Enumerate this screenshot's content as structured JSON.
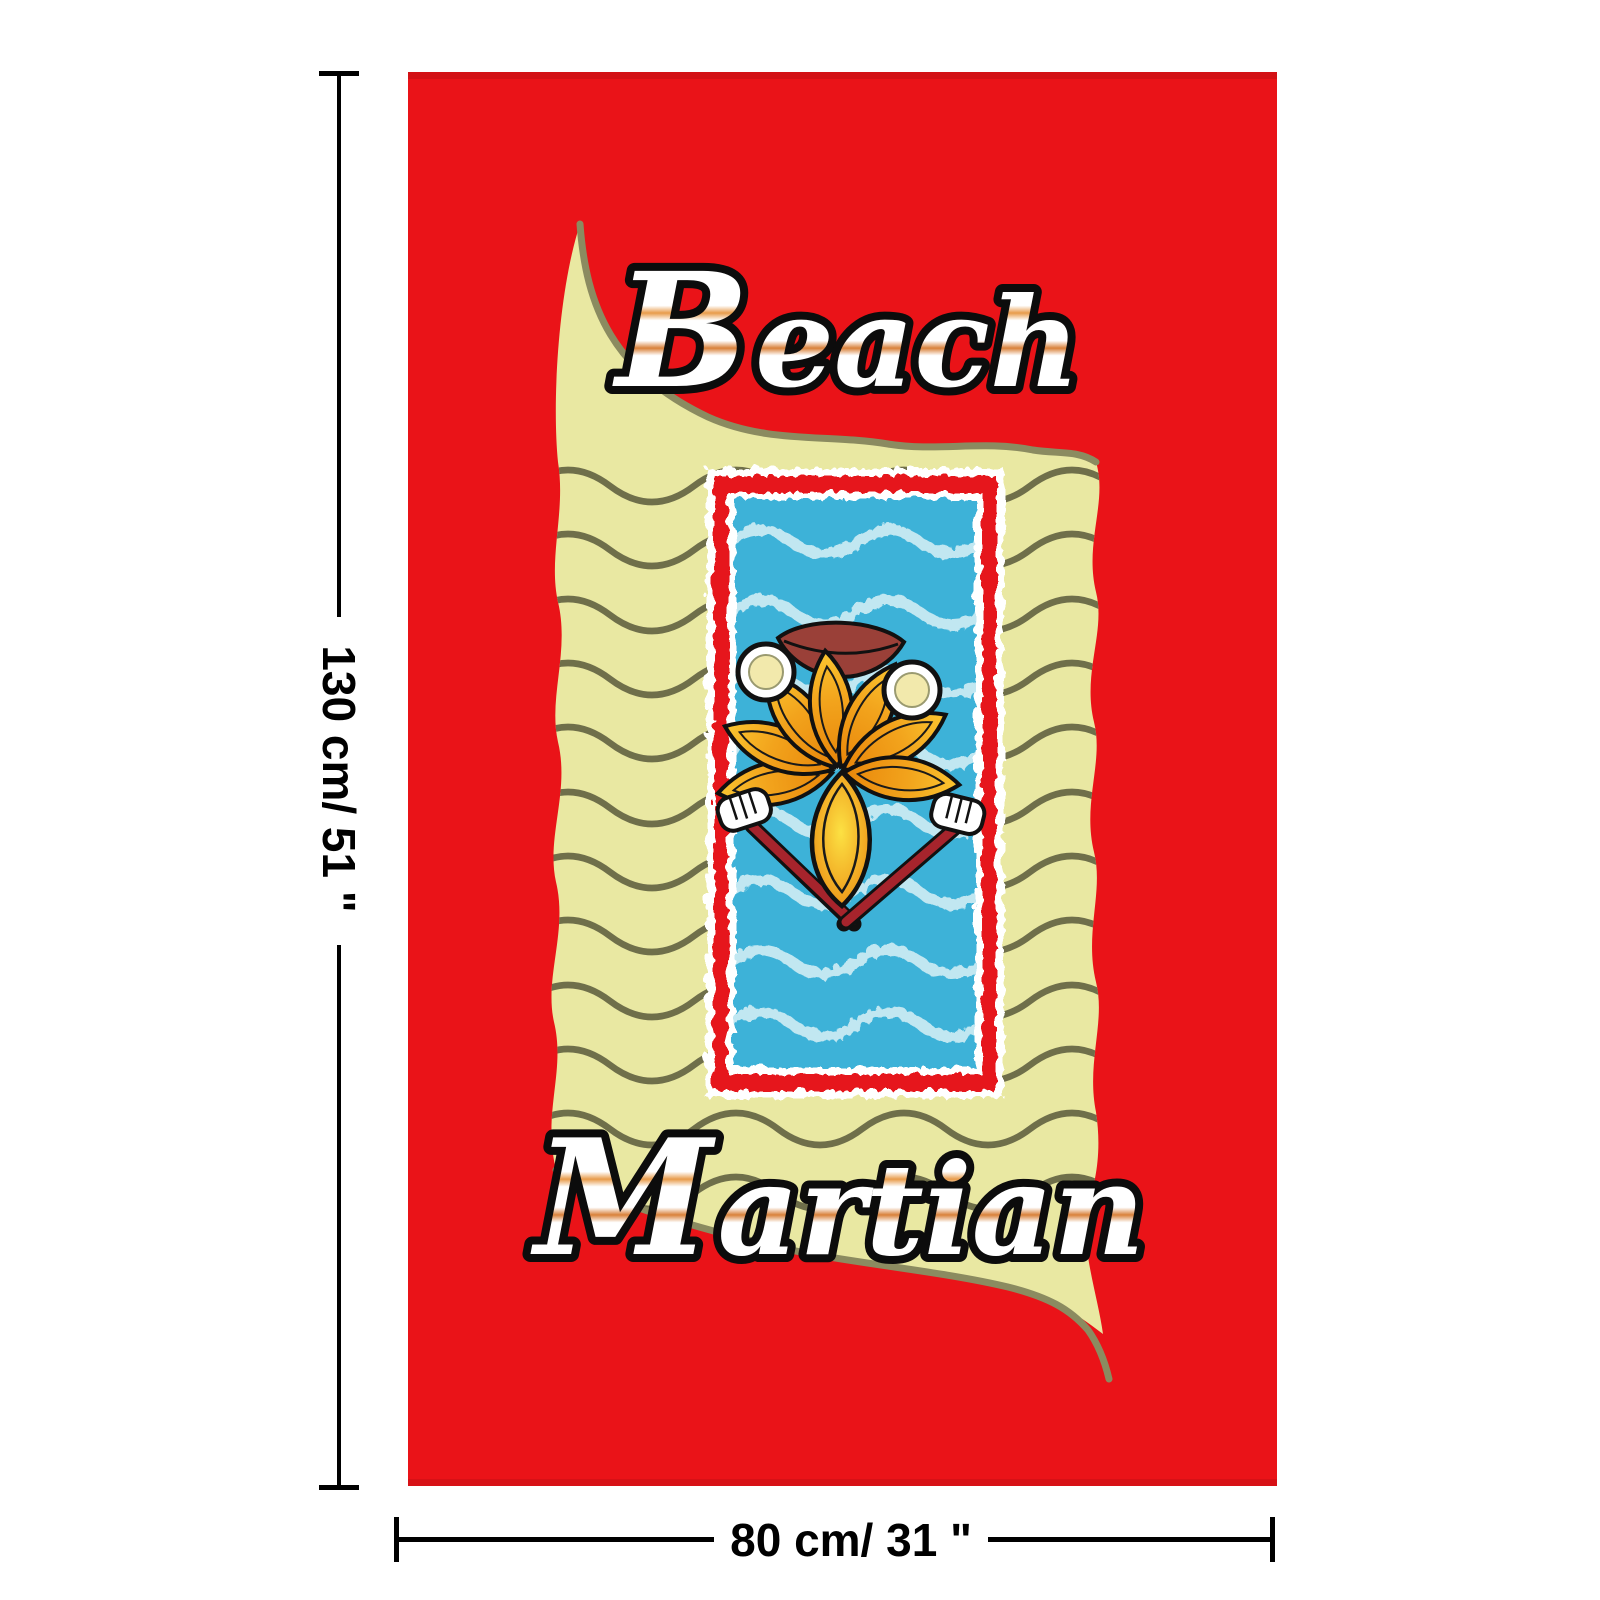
{
  "product": {
    "title_top_initial": "B",
    "title_top_rest": "each",
    "title_bottom_initial": "M",
    "title_bottom_rest": "artian"
  },
  "dimensions": {
    "height_label": "130 cm/ 51 \"",
    "width_label": "80 cm/ 31 \""
  },
  "colors": {
    "background_white": "#ffffff",
    "towel_red": "#ea1318",
    "towel_edge_dark_red": "#c01014",
    "sand_yellow": "#e9e8a2",
    "sand_wave_olive": "#6f6f4a",
    "sand_edge_olive": "#8b8b60",
    "panel_border_red": "#e6191f",
    "panel_white": "#ffffff",
    "water_blue": "#3cb2d8",
    "water_wave_white": "#d8f0f6",
    "petal_orange": "#f2a31c",
    "leaf_yellow": "#f7c62e",
    "arm_red": "#a6242c",
    "mouth_maroon": "#9a4038",
    "eye_center_yellow": "#f2e9ac",
    "hand_white": "#ffffff",
    "outline_black": "#111111",
    "dimension_black": "#000000"
  }
}
